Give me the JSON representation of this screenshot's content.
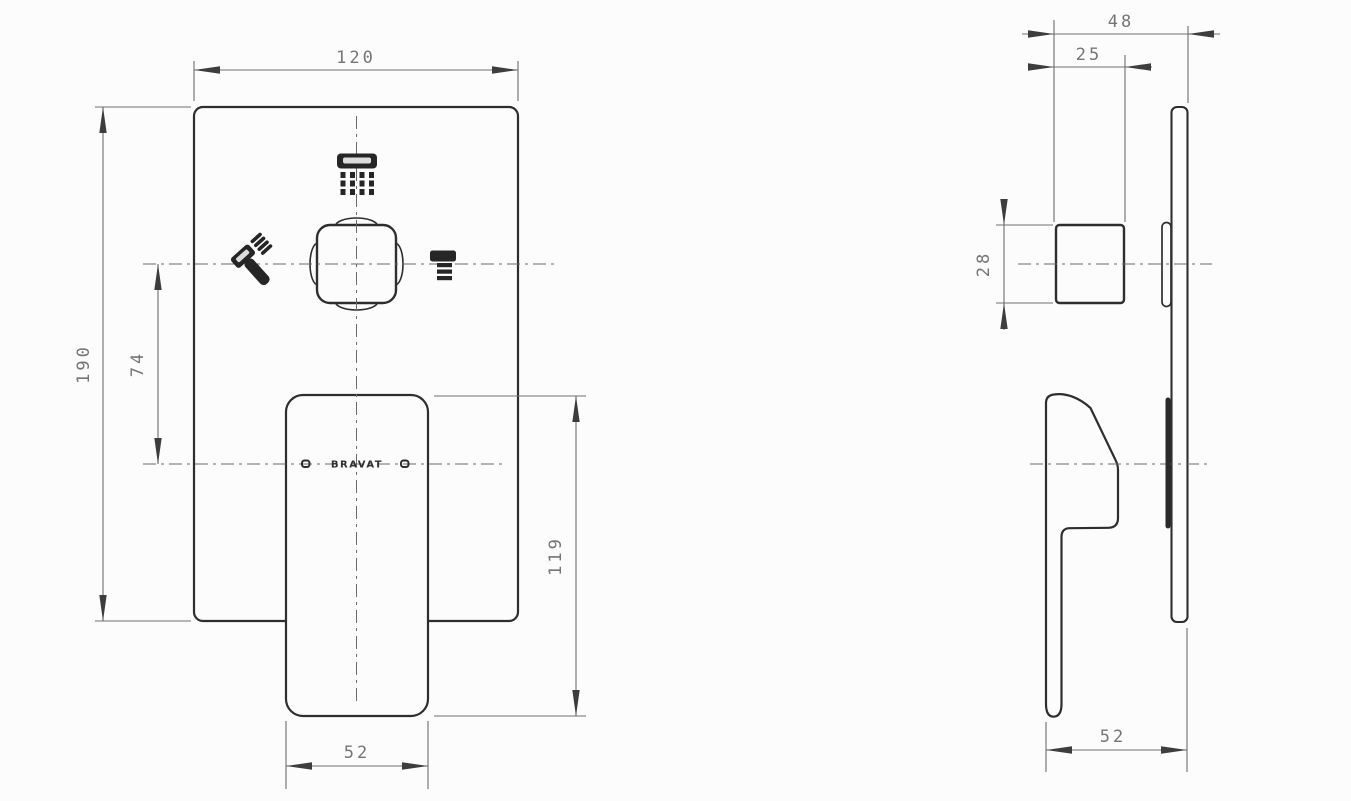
{
  "drawing": {
    "title": "concealed shower mixer dimension drawing",
    "brand": "BRAVAT",
    "front_view": {
      "dims": {
        "plate_width": "120",
        "plate_height": "190",
        "center_spacing": "74",
        "handle_length": "119",
        "handle_width": "52"
      },
      "icons": {
        "top": "overhead-shower",
        "left": "hand-shower",
        "right": "tub-spout"
      }
    },
    "side_view": {
      "dims": {
        "total_depth": "48",
        "knob_depth": "25",
        "knob_size": "28",
        "handle_depth": "52"
      }
    },
    "colors": {
      "background": "#fcfcfc",
      "object_line": "#2e2e2e",
      "dimension_line": "#6f6f6f",
      "dimension_text": "#757575",
      "arrow": "#3d3d3d"
    }
  }
}
